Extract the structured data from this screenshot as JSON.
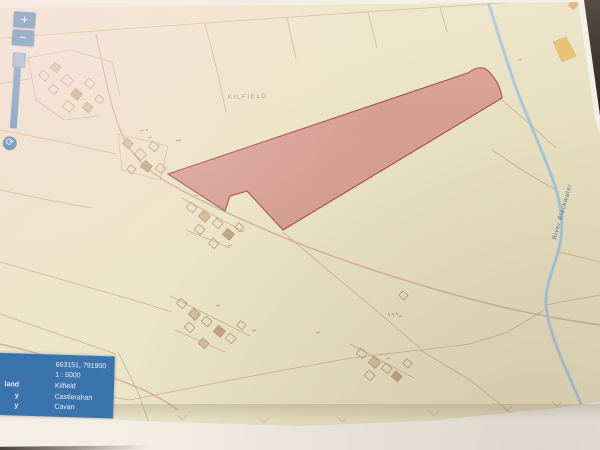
{
  "map": {
    "townland_label": "KILFIELD",
    "river_label": "River Blackwater"
  },
  "icons": {
    "zoom_in": "+",
    "zoom_out": "−",
    "refresh": "⟳"
  },
  "info_panel": {
    "coordinates": "663151, 791900",
    "scale": "1 : 5000",
    "rows": [
      {
        "label_fragment": "land",
        "value": "Kilfield"
      },
      {
        "label_fragment": "y",
        "value": "Castlerahan"
      },
      {
        "label_fragment": "y",
        "value": "Cavan"
      }
    ]
  },
  "colors": {
    "panel_blue": "#3b74ad",
    "control_blue": "#4c86ba",
    "parcel_fill": "#d6928a",
    "parcel_border": "#a6544c",
    "river_blue": "#a9cbe2",
    "highlight_yellow": "#e7bd5a",
    "map_cream": "#ebe3c5"
  }
}
